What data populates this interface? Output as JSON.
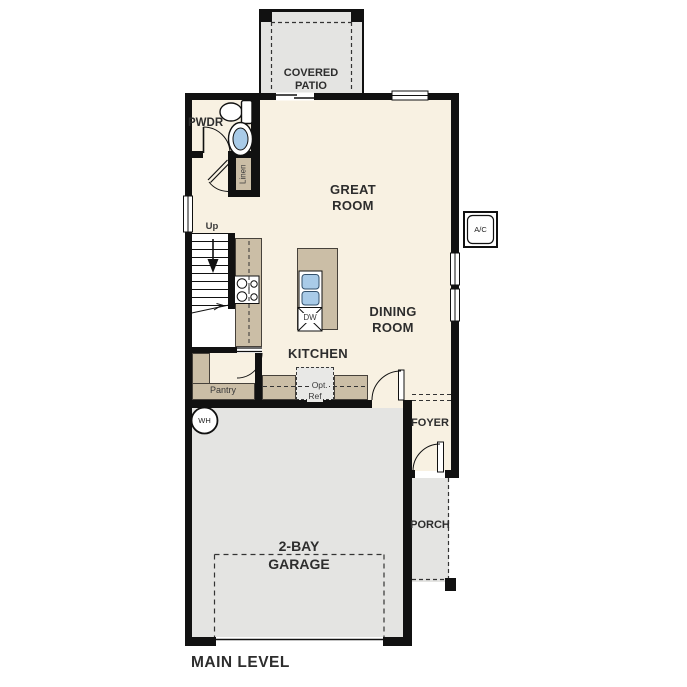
{
  "plan": {
    "title": "MAIN LEVEL",
    "rooms": {
      "covered_patio_1": "COVERED",
      "covered_patio_2": "PATIO",
      "great_room_1": "GREAT",
      "great_room_2": "ROOM",
      "dining_room_1": "DINING",
      "dining_room_2": "ROOM",
      "kitchen": "KITCHEN",
      "pwdr": "PWDR",
      "linen": "Linen",
      "pantry": "Pantry",
      "foyer": "FOYER",
      "porch": "PORCH",
      "garage_1": "2-BAY",
      "garage_2": "GARAGE"
    },
    "labels": {
      "up": "Up",
      "dw": "DW",
      "wh": "WH",
      "ac": "A/C",
      "opt_ref_1": "Opt.",
      "opt_ref_2": "Ref"
    },
    "colors": {
      "floor": "#f8f1e2",
      "exterior_concrete": "#e4e4e2",
      "counter_tan": "#cbbea6",
      "fixture_blue": "#a9cbe8",
      "wall": "#111111",
      "text": "#2d2d2d"
    }
  }
}
